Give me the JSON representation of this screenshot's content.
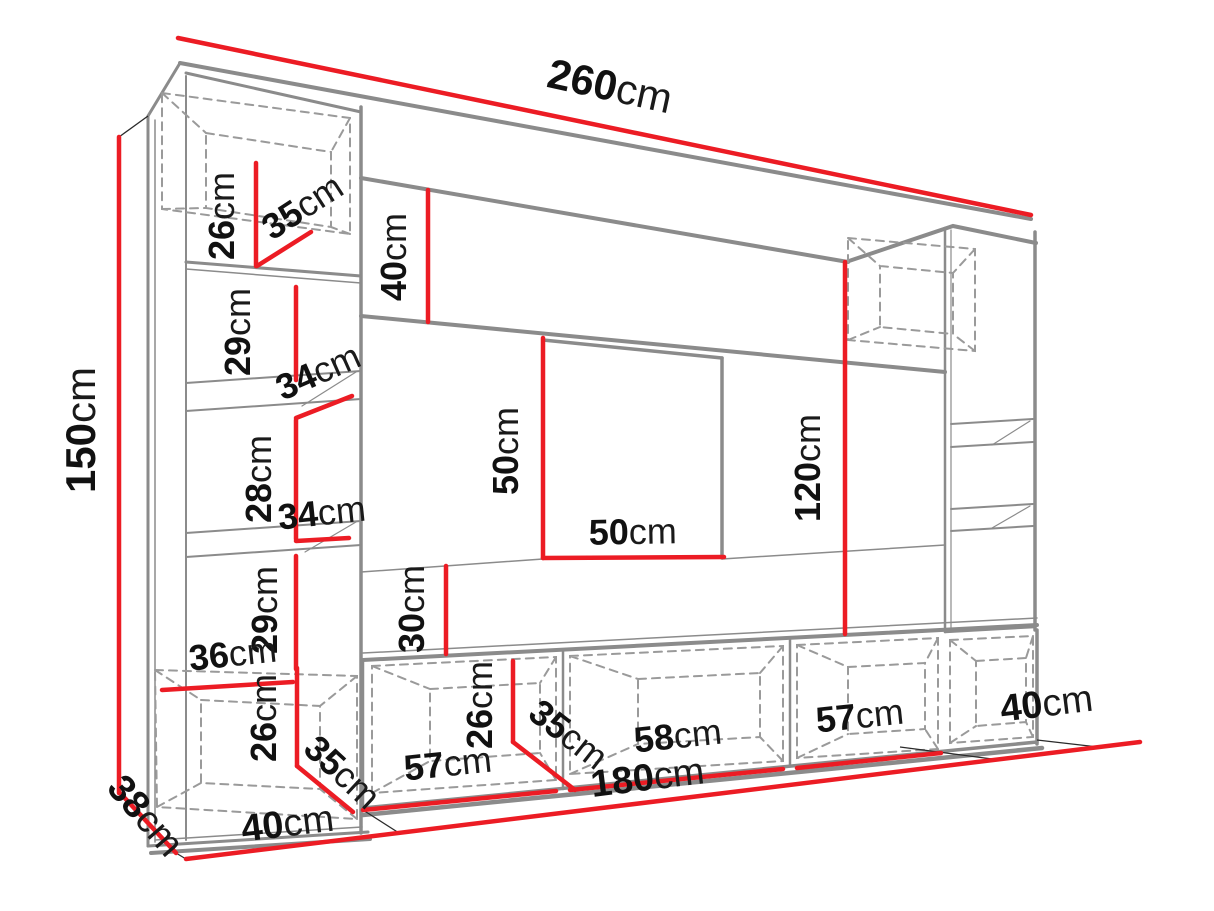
{
  "diagram": {
    "type": "furniture-dimension-diagram",
    "subject": "wall unit entertainment center line drawing with red dimension lines",
    "unit": "cm",
    "colors": {
      "dimension_line": "#ec1c24",
      "outline_gray": "#8b8b8b",
      "dashed_gray": "#9a9a9a",
      "label_text": "#111111",
      "background": "#ffffff"
    },
    "overall": {
      "width_cm": 260,
      "height_cm": 150,
      "side_depth_cm": 38
    },
    "labels": {
      "overall_width": {
        "value": "260",
        "unit": "cm"
      },
      "overall_height": {
        "value": "150",
        "unit": "cm"
      },
      "side_depth": {
        "value": "38",
        "unit": "cm"
      },
      "base_left_width": {
        "value": "40",
        "unit": "cm"
      },
      "base_stand_width": {
        "value": "180",
        "unit": "cm"
      },
      "base_right_width": {
        "value": "40",
        "unit": "cm"
      },
      "left_top_cabinet_height": {
        "value": "26",
        "unit": "cm"
      },
      "left_top_cabinet_depth": {
        "value": "35",
        "unit": "cm"
      },
      "left_shelf_gap_1": {
        "value": "29",
        "unit": "cm"
      },
      "left_shelf_depth_1": {
        "value": "34",
        "unit": "cm"
      },
      "left_shelf_gap_2": {
        "value": "28",
        "unit": "cm"
      },
      "left_shelf_depth_2": {
        "value": "34",
        "unit": "cm"
      },
      "left_shelf_gap_3": {
        "value": "29",
        "unit": "cm"
      },
      "left_bottom_cabinet_top": {
        "value": "36",
        "unit": "cm"
      },
      "left_bottom_cabinet_height": {
        "value": "26",
        "unit": "cm"
      },
      "left_bottom_cabinet_depth": {
        "value": "35",
        "unit": "cm"
      },
      "top_panel_height": {
        "value": "40",
        "unit": "cm"
      },
      "tv_niche_height": {
        "value": "50",
        "unit": "cm"
      },
      "tv_niche_width": {
        "value": "50",
        "unit": "cm"
      },
      "back_panel_lower_height": {
        "value": "30",
        "unit": "cm"
      },
      "right_column_height": {
        "value": "120",
        "unit": "cm"
      },
      "stand_cabinet_height": {
        "value": "26",
        "unit": "cm"
      },
      "stand_cabinet_depth": {
        "value": "35",
        "unit": "cm"
      },
      "stand_cabinet_1_width": {
        "value": "57",
        "unit": "cm"
      },
      "stand_cabinet_2_width": {
        "value": "58",
        "unit": "cm"
      },
      "stand_cabinet_3_width": {
        "value": "57",
        "unit": "cm"
      }
    }
  }
}
